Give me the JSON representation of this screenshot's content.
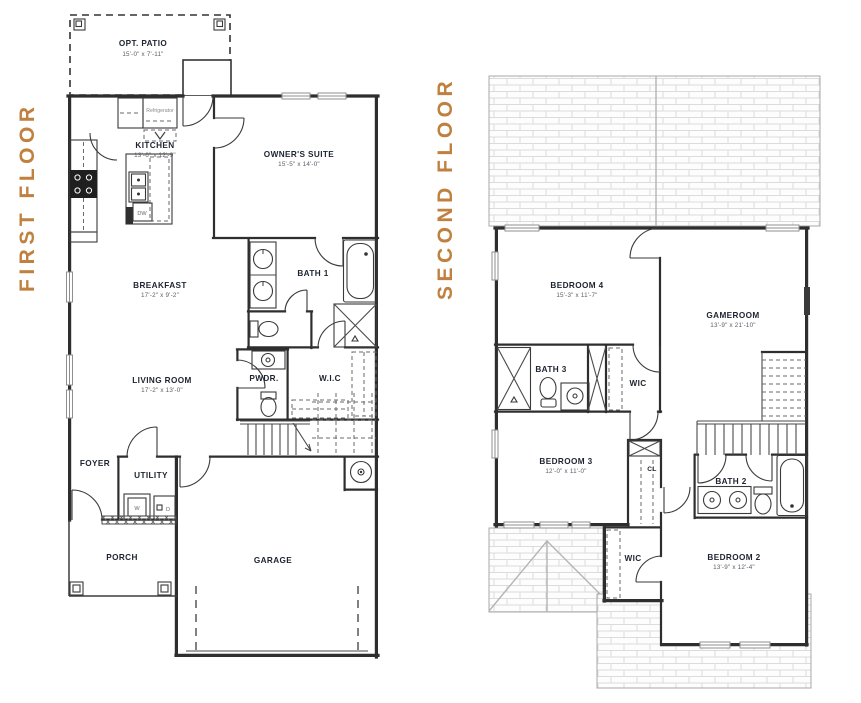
{
  "document": {
    "type": "residential floor plan",
    "background": "#ffffff"
  },
  "colors": {
    "floor_title": "#c0803f",
    "room_label": "#1d2430",
    "dim_label": "#5a5d66",
    "wall": "#2e2e2e",
    "roof_hatch": "#dcdcdc"
  },
  "first_floor": {
    "title": "FIRST FLOOR",
    "rooms": {
      "opt_patio": {
        "name": "OPT. PATIO",
        "dims": "15'-0\" x 7'-11\""
      },
      "kitchen": {
        "name": "KITCHEN",
        "dims": "13'-6\" x 12'-9\""
      },
      "owners_suite": {
        "name": "OWNER'S SUITE",
        "dims": "15'-5\" x 14'-0\""
      },
      "bath_1": {
        "name": "BATH 1"
      },
      "breakfast": {
        "name": "BREAKFAST",
        "dims": "17'-2\" x 9'-2\""
      },
      "living_room": {
        "name": "LIVING ROOM",
        "dims": "17'-2\" x 13'-0\""
      },
      "powder": {
        "name": "PWDR."
      },
      "wic": {
        "name": "W.I.C"
      },
      "foyer": {
        "name": "FOYER"
      },
      "utility": {
        "name": "UTILITY"
      },
      "porch": {
        "name": "PORCH"
      },
      "garage": {
        "name": "GARAGE"
      }
    },
    "appliances": {
      "refrigerator": "Refrigerator",
      "dishwasher": "DW",
      "washer": "W",
      "dryer": "D"
    }
  },
  "second_floor": {
    "title": "SECOND FLOOR",
    "rooms": {
      "bedroom_4": {
        "name": "BEDROOM 4",
        "dims": "15'-3\" x 11'-7\""
      },
      "gameroom": {
        "name": "GAMEROOM",
        "dims": "13'-9\" x 21'-10\""
      },
      "bath_3": {
        "name": "BATH 3"
      },
      "wic_bath3": {
        "name": "WIC"
      },
      "bedroom_3": {
        "name": "BEDROOM 3",
        "dims": "12'-0\" x 11'-0\""
      },
      "closet": {
        "name": "CL"
      },
      "bath_2": {
        "name": "BATH 2"
      },
      "wic_bedroom2": {
        "name": "WIC"
      },
      "bedroom_2": {
        "name": "BEDROOM 2",
        "dims": "13'-9\" x 12'-4\""
      }
    }
  }
}
